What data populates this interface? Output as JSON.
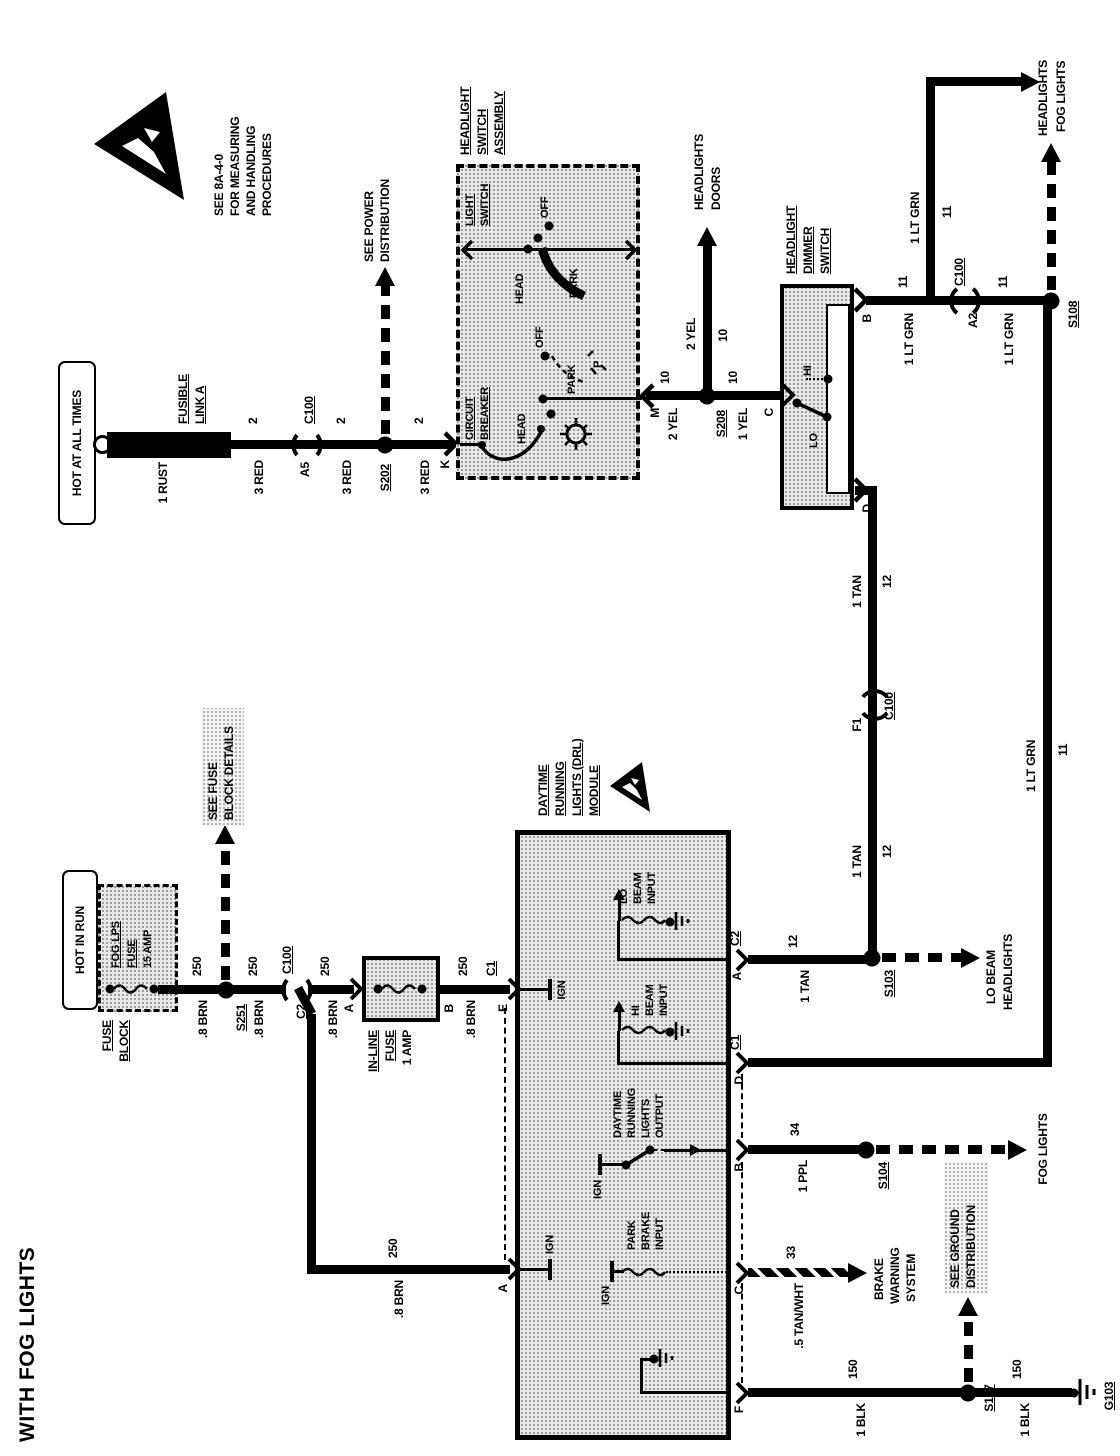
{
  "title": "WITH FOG LIGHTS",
  "note": {
    "l1": "SEE 8A-4-0",
    "l2": "FOR MEASURING",
    "l3": "AND HANDLING",
    "l4": "PROCEDURES"
  },
  "power": {
    "box": "HOT AT ALL TIMES",
    "link1": "FUSIBLE",
    "link2": "LINK A",
    "wire0": "1 RUST",
    "ckt": "2",
    "wire": "3 RED",
    "a5": "A5",
    "c100": "C100",
    "s202": "S202",
    "see1": "SEE POWER",
    "see2": "DISTRIBUTION",
    "k": "K"
  },
  "lightswitch": {
    "t1": "HEADLIGHT",
    "t2": "SWITCH",
    "t3": "ASSEMBLY",
    "cb1": "CIRCUIT",
    "cb2": "BREAKER",
    "ls1": "LIGHT",
    "ls2": "SWITCH",
    "head": "HEAD",
    "off": "OFF",
    "park": "PARK",
    "p": "P",
    "m": "M"
  },
  "yel": {
    "w2": "2 YEL",
    "w1": "1 YEL",
    "ckt": "10",
    "s208": "S208",
    "c": "C",
    "d1": "HEADLIGHTS",
    "d2": "DOORS"
  },
  "dimmer": {
    "t1": "HEADLIGHT",
    "t2": "DIMMER",
    "t3": "SWITCH",
    "hi": "HI",
    "lo": "LO",
    "b": "B",
    "d": "D"
  },
  "grn": {
    "w": "1 LT GRN",
    "ckt": "11",
    "a2": "A2",
    "c100": "C100",
    "s108": "S108",
    "d1": "HEADLIGHTS",
    "d2": "FOG LIGHTS"
  },
  "tan": {
    "w": "1 TAN",
    "ckt": "12",
    "f1": "F1",
    "c100": "C100",
    "s103": "S103",
    "d1": "LO BEAM",
    "d2": "HEADLIGHTS"
  },
  "run": {
    "box": "HOT IN RUN",
    "fb1": "FUSE",
    "fb2": "BLOCK",
    "f1": "FOG LPS",
    "f2": "FUSE",
    "f3": "15 AMP",
    "s251": "S251",
    "see1": "SEE FUSE",
    "see2": "BLOCK DETAILS",
    "c2": "C2",
    "c100": "C100",
    "w": ".8 BRN",
    "ckt": "250",
    "a": "A",
    "b": "B",
    "e": "E",
    "if1": "IN-LINE",
    "if2": "FUSE",
    "if3": "1 AMP",
    "c1": "C1"
  },
  "module": {
    "t1": "DAYTIME",
    "t2": "RUNNING",
    "t3": "LIGHTS (DRL)",
    "t4": "MODULE",
    "ign": "IGN",
    "lo1": "LO",
    "lo2": "BEAM",
    "lo3": "INPUT",
    "hi1": "HI",
    "hi2": "BEAM",
    "hi3": "INPUT",
    "o1": "DAYTIME",
    "o2": "RUNNING",
    "o3": "LIGHTS",
    "o4": "OUTPUT",
    "pb1": "PARK",
    "pb2": "BRAKE",
    "pb3": "INPUT",
    "ta": "A",
    "tc2": "C2",
    "td": "D",
    "tc1": "C1",
    "tb": "B",
    "tc": "C",
    "tf": "F"
  },
  "ppl": {
    "w": "1 PPL",
    "ckt": "34",
    "s104": "S104",
    "dest": "FOG LIGHTS"
  },
  "tw": {
    "w": ".5 TAN/WHT",
    "ckt": "33",
    "d1": "BRAKE",
    "d2": "WARNING",
    "d3": "SYSTEM"
  },
  "blk": {
    "w": "1 BLK",
    "ckt": "150",
    "s107": "S107",
    "g103": "G103",
    "see1": "SEE GROUND",
    "see2": "DISTRIBUTION"
  }
}
